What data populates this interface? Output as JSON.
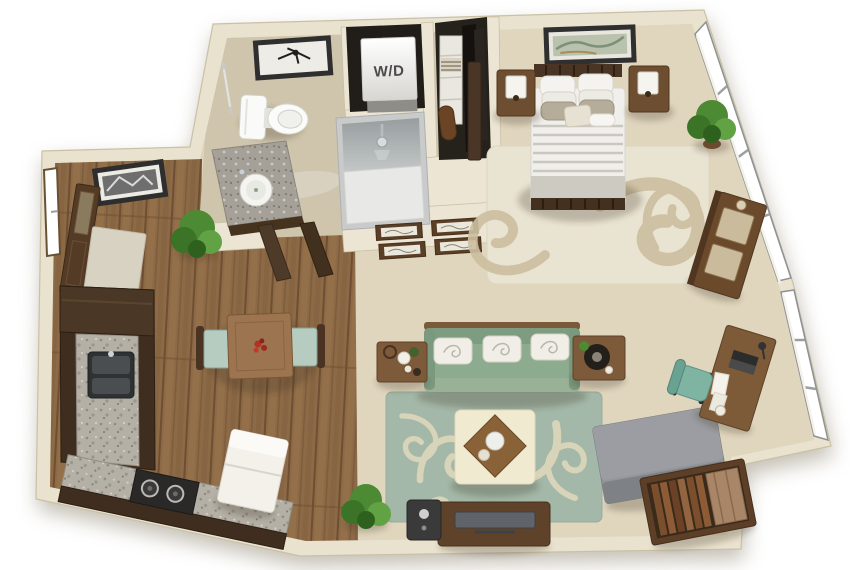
{
  "scene": {
    "type": "3d-floor-plan",
    "subject": "studio apartment",
    "view": "top-down 3d render",
    "background": "#ffffff"
  },
  "labels": {
    "washer_dryer": "W/D"
  },
  "palette": {
    "wall": "#e9e2ce",
    "wall_edge": "#c9c0a5",
    "tile_floor": "#cfc5ad",
    "carpet_floor": "#ddd2ba",
    "wood_floor": "#8d6a46",
    "living_rug": "#a3b8a8",
    "rug_scroll": "#dbd6ba",
    "bedroom_rug": "#e9e3d2",
    "sofa_green": "#8cab8f",
    "chaise_gray": "#8f9196",
    "desk_chair_teal": "#7fb3a2",
    "kitchen_cabinet": "#3f2e1f",
    "granite": "#b4b0a6",
    "furniture_wood": "#7d5a3a",
    "appliance_white": "#f3f1ea",
    "plant_green": "#4c8a33",
    "bed_linen": "#f0efeb",
    "accent_red": "#b23226"
  },
  "rooms": [
    {
      "id": "bathroom",
      "items": [
        "framed-art",
        "towel-bar",
        "toilet",
        "vanity-sink",
        "shower"
      ]
    },
    {
      "id": "laundry-closet",
      "items": [
        "washer-dryer-unit"
      ]
    },
    {
      "id": "hall-closet",
      "items": [
        "shelf-tower",
        "towels",
        "hanging-clothes",
        "storage-roll"
      ]
    },
    {
      "id": "hallway",
      "items": [
        "open-doors",
        "gallery-frames"
      ]
    },
    {
      "id": "bedroom",
      "items": [
        "framed-art",
        "bed",
        "nightstand-left",
        "nightstand-right",
        "area-rug",
        "potted-plant",
        "dresser",
        "closet-door",
        "window-wall"
      ]
    },
    {
      "id": "entry",
      "items": [
        "window",
        "framed-art",
        "front-door",
        "doormat",
        "potted-plant"
      ]
    },
    {
      "id": "kitchen",
      "items": [
        "upper-cabinet",
        "counter-left-run",
        "counter-bottom-run",
        "sink",
        "cooktop",
        "refrigerator"
      ]
    },
    {
      "id": "dining-area",
      "items": [
        "dining-table",
        "centerpiece-flowers",
        "dining-chair-left",
        "dining-chair-right"
      ]
    },
    {
      "id": "living-room",
      "items": [
        "sofa",
        "throw-pillows",
        "end-table-left",
        "serving-tray",
        "end-table-right",
        "table-lamp",
        "area-rug",
        "ottoman-coffee-table",
        "wood-tray",
        "tv-console",
        "television",
        "speaker",
        "potted-plant",
        "chaise-lounge",
        "bookshelf",
        "desk",
        "laptop",
        "desk-chair",
        "window-wall"
      ]
    }
  ]
}
